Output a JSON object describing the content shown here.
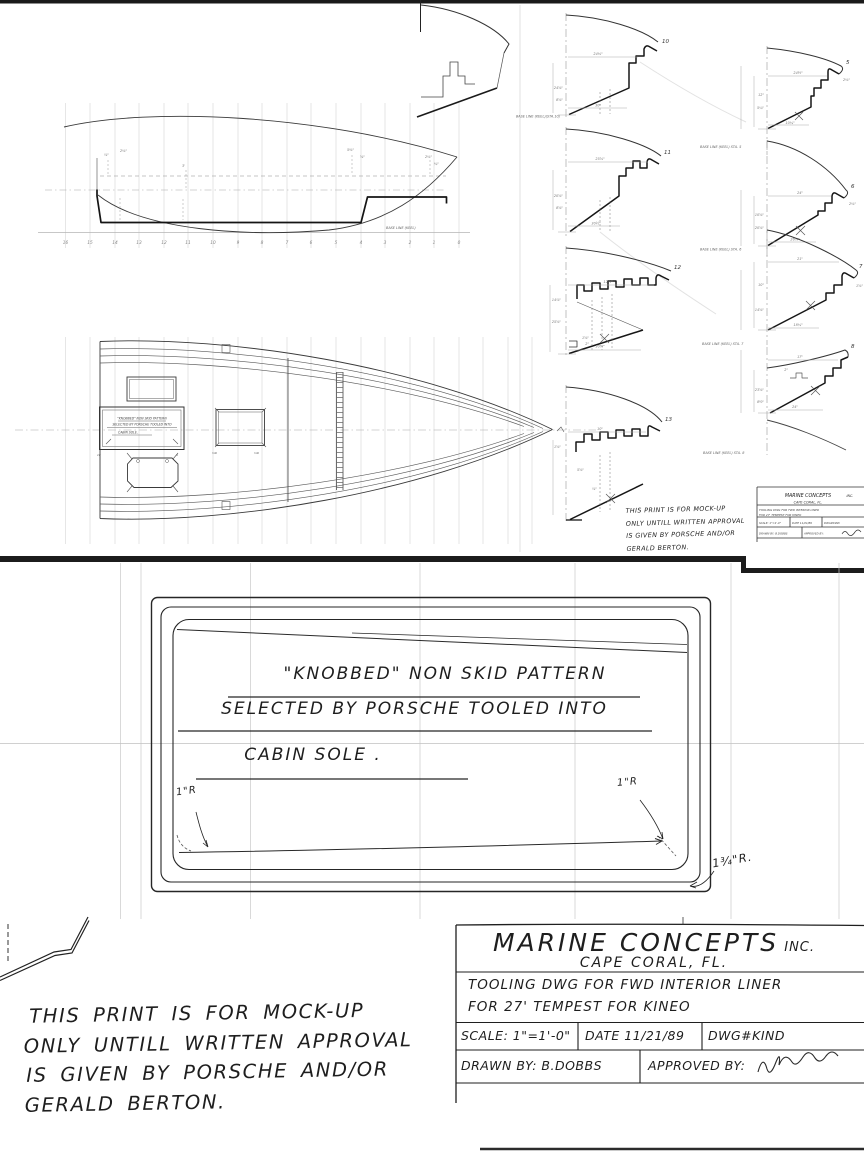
{
  "colors": {
    "ink": "#222222",
    "pencil": "#8a8a8a",
    "grid": "#c9c9c9",
    "crease": "#c4c4c4",
    "paper": "#ffffff"
  },
  "title_block": {
    "company_main": "MARINE CONCEPTS",
    "company_suffix": "INC.",
    "location": "CAPE CORAL, FL.",
    "desc1": "TOOLING DWG FOR FWD INTERIOR LINER",
    "desc2": "FOR 27' TEMPEST FOR KINEO",
    "scale": "SCALE: 1\"=1'-0\"",
    "date": "DATE 11/21/89",
    "dwg_no": "DWG#KIND",
    "drawn_by": "DRAWN BY: B.DOBBS",
    "approved_by": "APPROVED BY:"
  },
  "mock_up_note": {
    "line1": "THIS PRINT IS FOR MOCK-UP",
    "line2": "ONLY  UNTILL WRITTEN APPROVAL",
    "line3": "IS GIVEN BY PORSCHE AND/OR",
    "line4": "GERALD BERTON."
  },
  "panel_note": {
    "line1": "\"KNOBBED\" NON SKID PATTERN",
    "line2": "SELECTED BY PORSCHE TOOLED INTO",
    "line3": "CABIN SOLE ."
  },
  "radius_labels": {
    "left": "1\"R",
    "right": "1\"R",
    "corner": "1¾\"R."
  },
  "profile": {
    "base_line_label": "BASE LINE (KEEL)",
    "stations": [
      "16",
      "15",
      "14",
      "13",
      "12",
      "11",
      "10",
      "9",
      "8",
      "7",
      "6",
      "5",
      "4",
      "3",
      "2",
      "1",
      "0"
    ],
    "dims": [
      "⅞\"",
      "2⅛\"",
      "3'",
      "5⅜\"",
      "⅝\"",
      "2⅛\"",
      "¾\""
    ]
  },
  "plan": {
    "annotation": {
      "line1": "\"KNOBBED\" NON SKID PATTERN",
      "line2": "SELECTED BY PORSCHE TOOLED INTO",
      "line3": "CABIN SOLE."
    },
    "corner_labels": [
      "1R",
      "R",
      "⅝R",
      "⅝R"
    ]
  },
  "sections": {
    "middle": [
      {
        "station": "10",
        "base_label": "BASE LINE (KEEL)(STA.10)",
        "dims": [
          "24⅛\"",
          "24⅝\"",
          "8⅝\"",
          "30\""
        ]
      },
      {
        "station": "11",
        "dims": [
          "25⅝\"",
          "20⅝\"",
          "8⅝\"",
          "30½\""
        ]
      },
      {
        "station": "12",
        "dims": [
          "12½\"",
          "14⅞\"",
          "25⅝\"",
          "30⅝\"",
          "1⅝\"",
          "2\""
        ]
      },
      {
        "station": "13",
        "dims": [
          "10\"",
          "1⅝\"",
          "5⅝\"",
          "⅞\""
        ]
      }
    ],
    "right": [
      {
        "station": "5",
        "base_label": "BASE LINE (KEEL) STA. 5",
        "dims": [
          "24½\"",
          "12\"",
          "5¼\"",
          "10¼\"",
          "2⅛\""
        ]
      },
      {
        "station": "6",
        "base_label": "BASE LINE (KEEL) STA. 6",
        "dims": [
          "24\"",
          "10⅝\"",
          "20⅝\"",
          "26⅝\"",
          "2⅛\""
        ]
      },
      {
        "station": "7",
        "base_label": "BASE LINE (KEEL) STA. 7",
        "dims": [
          "21\"",
          "10\"",
          "14⅝\"",
          "18¼\"",
          "1⅝\""
        ]
      },
      {
        "station": "8",
        "base_label": "BASE LINE (KEEL) STA. 8",
        "dims": [
          "17\"",
          "23⅝\"",
          "8½\"",
          "24\"",
          "2\""
        ]
      }
    ]
  }
}
